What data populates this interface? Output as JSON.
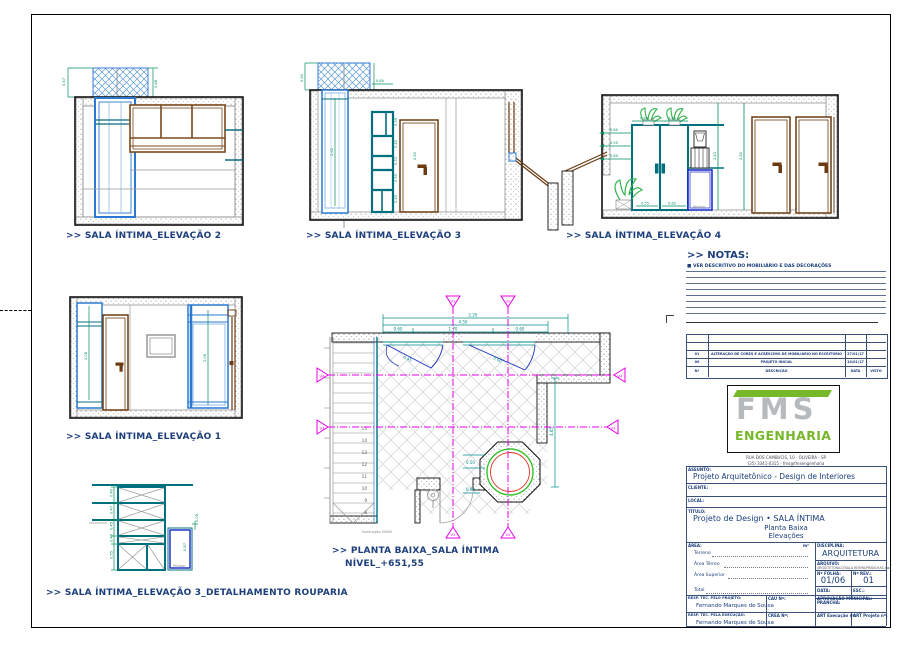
{
  "sheet": {
    "bg": "#ffffff",
    "border": "#000000"
  },
  "views": {
    "elevation2": {
      "title": ">> SALA ÍNTIMA_ELEVAÇÃO 2",
      "dims": [
        "0.47",
        "0.48",
        "1.05"
      ]
    },
    "elevation3": {
      "title": ">> SALA ÍNTIMA_ELEVAÇÃO 3",
      "dims": [
        "0.50",
        "2.62",
        "0.35",
        "0.40",
        "0.33",
        "0.50",
        "0.40",
        "2.50",
        "0.80"
      ]
    },
    "elevation4": {
      "title": ">> SALA ÍNTIMA_ELEVAÇÃO 4",
      "minibar": "Minibar",
      "dims_left": [
        "0.60",
        "0.55",
        "0.60"
      ],
      "dims_top": [
        "0.60",
        "0.60"
      ],
      "dims_v": [
        "2.43",
        "2.50"
      ],
      "dims_b": [
        "0.55",
        "0.62"
      ]
    },
    "elevation1": {
      "title": ">> SALA ÍNTIMA_ELEVAÇÃO 1",
      "dims": [
        "2.08",
        "2.08"
      ]
    },
    "detail3": {
      "title": ">> SALA ÍNTIMA_ELEVAÇÃO 3_DETALHAMENTO ROUPARIA",
      "minibar": "Minibar",
      "dims": [
        "0.40",
        "0.47",
        "0.45",
        "0.47",
        "0.55"
      ],
      "dims_right": [
        "0.05",
        "0.87"
      ]
    },
    "plan": {
      "title": ">> PLANTA BAIXA_SALA ÍNTIMA",
      "level": "NÍVEL_+651,55",
      "note": "Iluminação 3000k",
      "stairs": [
        "8",
        "9",
        "10",
        "11",
        "12",
        "13",
        "14",
        "15"
      ],
      "markers": {
        "v1": "V1",
        "v2": "V2",
        "v3": "V3",
        "v4": "V4"
      },
      "dims_top": [
        "2.20",
        "4.50",
        "0.60",
        "1.70",
        "0.60"
      ],
      "dim_right": "4.65",
      "dims_win": [
        "0.45",
        "0.60"
      ],
      "dims_jac": [
        "0.50",
        "0.90"
      ]
    }
  },
  "notes": {
    "title": ">> NOTAS:",
    "item1": "■ VER DESCRITIVO DO MOBILIÁRIO E DAS DECORAÇÕES"
  },
  "revisions": {
    "r1": {
      "n": "01",
      "desc": "ALTERAÇÃO DE CORES E ACRÉSCIMO DE MOBILIÁRIO NO ESCRITÓRIO",
      "date": "27/01/17"
    },
    "r0": {
      "n": "00",
      "desc": "PROJETO INICIAL",
      "date": "14/01/17"
    },
    "footer": {
      "n": "Nº",
      "desc": "DESCRIÇÃO",
      "date": "DATA",
      "visto": "VISTO"
    }
  },
  "titleblock": {
    "logo_fms": "FMS",
    "logo_eng": "ENGENHARIA",
    "address1": "RUA DOS CAMBUCIS, 10 - OLIVEIRA - SP",
    "address2": "(35) 3341-0315  -  fms@fmsengenharia",
    "assunto_label": "ASSUNTO:",
    "assunto": "Projeto Arquitetônico - Design de Interiores",
    "cliente_label": "CLIENTE:",
    "local_label": "LOCAL:",
    "titulo_label": "TÍTULO:",
    "titulo": "Projeto de Design • SALA ÍNTIMA",
    "titulo_sub1": "Planta Baixa",
    "titulo_sub2": "Elevações",
    "area_label": "ÁREA:",
    "area_unit": "m²",
    "area_terreno": "Terreno",
    "area_terreo": "Área Térreo",
    "area_superior": "Área Superior",
    "area_total": "Total",
    "disciplina_label": "DISCIPLINA:",
    "disciplina": "ARQUITETURA",
    "arquivo_label": "ARQUIVO:",
    "arquivo": "ARQUITETONICO/SALA INTIMA/PRANCHAS.dwg",
    "folha_label": "Nº FOLHA:",
    "folha": "01/06",
    "rev_label": "Nº REV.:",
    "rev": "01",
    "data_label": "DATA:",
    "esc_label": "ESC.:",
    "prancha_label": "PRANCHA:",
    "resp_proj_label": "RESP. TEC. PELO PROJETO:",
    "resp_proj": "Fernando Marques de Sousa",
    "cau_label": "CAU Nº:",
    "aprov_label": "APROVAÇÃO MUNICIPAL:",
    "resp_exec_label": "RESP. TEC. PELA EXECUÇÃO:",
    "resp_exec": "Fernando Marques de Sousa",
    "crea_label": "CREA Nº:",
    "art_exec_label": "ART Execução nº:",
    "art_proj_label": "ART Projeto nº:"
  }
}
